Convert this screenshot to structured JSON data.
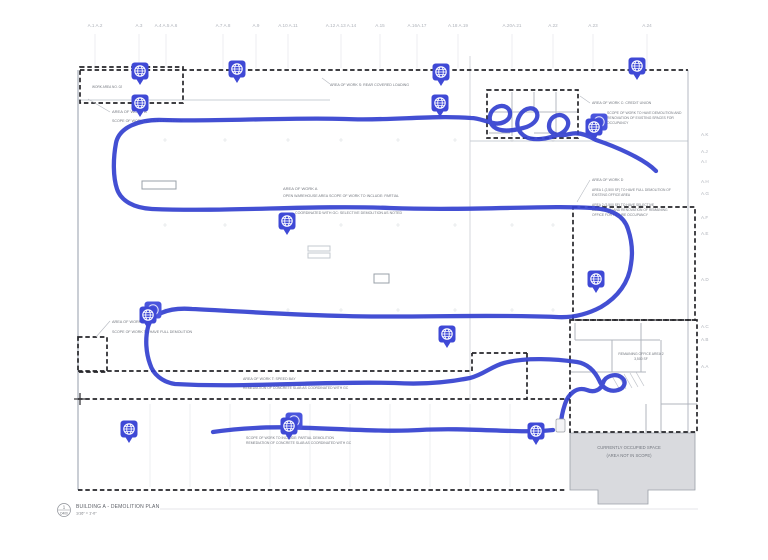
{
  "colors": {
    "path_blue": "#3340cf",
    "pin_blue": "#3f49d6",
    "pin_back": "#4a55dd",
    "dash_black": "#26262a",
    "wall_gray": "#b4bac3",
    "occupied_fill": "#d9dade",
    "annotation_text": "#73777f",
    "grid_text": "#aeb2ba"
  },
  "grid_top": {
    "y": 27,
    "labels": [
      {
        "t": "A.1 A.2",
        "x": 95
      },
      {
        "t": "A.3",
        "x": 139
      },
      {
        "t": "A.4 A.5 A.6",
        "x": 166
      },
      {
        "t": "A.7 A.8",
        "x": 223
      },
      {
        "t": "A.9",
        "x": 256
      },
      {
        "t": "A.10  A.11",
        "x": 288
      },
      {
        "t": "A.12 A.13 A.14",
        "x": 341
      },
      {
        "t": "A.15",
        "x": 380
      },
      {
        "t": "A.16A.17",
        "x": 417
      },
      {
        "t": "A.18  A.19",
        "x": 458
      },
      {
        "t": "A.20A.21",
        "x": 512
      },
      {
        "t": "A.22",
        "x": 553
      },
      {
        "t": "A.23",
        "x": 593
      },
      {
        "t": "A.24",
        "x": 647
      }
    ]
  },
  "grid_right": {
    "x": 701,
    "labels": [
      {
        "t": "A.K",
        "y": 136
      },
      {
        "t": "A.J",
        "y": 153
      },
      {
        "t": "A.I",
        "y": 163
      },
      {
        "t": "A.H",
        "y": 183
      },
      {
        "t": "A.G",
        "y": 195
      },
      {
        "t": "A.F",
        "y": 219
      },
      {
        "t": "A.E",
        "y": 235
      },
      {
        "t": "A.D",
        "y": 281
      },
      {
        "t": "A.C",
        "y": 328
      },
      {
        "t": "A.B",
        "y": 341
      },
      {
        "t": "A.A",
        "y": 368
      }
    ]
  },
  "annotations": [
    {
      "t": "WORK AREA NO. 02",
      "x": 92,
      "y": 88,
      "s": 3.2
    },
    {
      "t": "AREA OF WORK B",
      "x": 112,
      "y": 113,
      "s": 4
    },
    {
      "t": "SCOPE OF WORK TO HAVE DEMOLITION",
      "x": 112,
      "y": 122,
      "s": 3.6
    },
    {
      "t": "AREA OF WORK S: REAR COVERED LOADING",
      "x": 330,
      "y": 86,
      "s": 3.6
    },
    {
      "t": "AREA OF WORK C: CREDIT UNION",
      "x": 592,
      "y": 104,
      "s": 3.6
    },
    {
      "t": "SCOPE OF WORK TO HAVE DEMOLITION AND",
      "x": 607,
      "y": 114,
      "s": 3.4
    },
    {
      "t": "RENOVATION OF EXISTING SPACES FOR",
      "x": 607,
      "y": 119,
      "s": 3.4
    },
    {
      "t": "OCCUPANCY",
      "x": 607,
      "y": 124,
      "s": 3.4
    },
    {
      "t": "AREA OF WORK D",
      "x": 592,
      "y": 181,
      "s": 3.6
    },
    {
      "t": "AREA 1 (2,500 SF) TO HAVE FULL DEMOLITION OF",
      "x": 592,
      "y": 191,
      "s": 3.3
    },
    {
      "t": "EXISTING OFFICE AREA",
      "x": 592,
      "y": 196,
      "s": 3.3
    },
    {
      "t": "AREA 2 (3,500 SF) TO HAVE SELECTIVE",
      "x": 592,
      "y": 206,
      "s": 3.3
    },
    {
      "t": "DEMOLITION AND RENOVATION OF REMAINING",
      "x": 592,
      "y": 211,
      "s": 3.3
    },
    {
      "t": "OFFICE FOR FUTURE OCCUPANCY",
      "x": 592,
      "y": 216,
      "s": 3.3
    },
    {
      "t": "AREA OF WORK A",
      "x": 283,
      "y": 190,
      "s": 4
    },
    {
      "t": "OPEN WAREHOUSE AREA SCOPE OF WORK TO INCLUDE: PARTIAL",
      "x": 283,
      "y": 197,
      "s": 3.6
    },
    {
      "t": "COORDINATED WITH GC: SELECTIVE DEMOLITION AS NOTED",
      "x": 295,
      "y": 214,
      "s": 3.6
    },
    {
      "t": "AREA OF WORK W",
      "x": 112,
      "y": 323,
      "s": 3.8
    },
    {
      "t": "SCOPE OF WORK TO HAVE FULL DEMOLITION",
      "x": 112,
      "y": 333,
      "s": 3.6
    },
    {
      "t": "AREA OF WORK T: SPEED BAY",
      "x": 243,
      "y": 380,
      "s": 3.6
    },
    {
      "t": "REMEDIATION OF CONCRETE SLAB AS COORDINATED WITH GC",
      "x": 243,
      "y": 389,
      "s": 3.4
    },
    {
      "t": "SCOPE OF WORK TO INCLUDE: PARTIAL DEMOLITION",
      "x": 246,
      "y": 439,
      "s": 3.4
    },
    {
      "t": "REMEDIATION OF CONCRETE SLAB AS COORDINATED WITH GC",
      "x": 246,
      "y": 444,
      "s": 3.4
    },
    {
      "t": "REMAINING OFFICE AREA 2",
      "x": 641,
      "y": 355,
      "s": 3.4,
      "a": "middle"
    },
    {
      "t": "3,500 SF",
      "x": 641,
      "y": 360,
      "s": 3.4,
      "a": "middle"
    },
    {
      "t": "CURRENTLY OCCUPIED SPACE",
      "x": 629,
      "y": 449,
      "s": 4.2,
      "a": "middle"
    },
    {
      "t": "(AREA NOT IN SCOPE)",
      "x": 629,
      "y": 457,
      "s": 4.2,
      "a": "middle"
    }
  ],
  "pins": [
    {
      "x": 140,
      "y": 71
    },
    {
      "x": 237,
      "y": 69
    },
    {
      "x": 441,
      "y": 72
    },
    {
      "x": 637,
      "y": 66
    },
    {
      "x": 140,
      "y": 103
    },
    {
      "x": 440,
      "y": 103
    },
    {
      "x": 594,
      "y": 127,
      "double": true
    },
    {
      "x": 287,
      "y": 221
    },
    {
      "x": 596,
      "y": 279
    },
    {
      "x": 148,
      "y": 315,
      "double": true
    },
    {
      "x": 447,
      "y": 334
    },
    {
      "x": 129,
      "y": 429
    },
    {
      "x": 289,
      "y": 426,
      "double": true
    },
    {
      "x": 536,
      "y": 431
    }
  ],
  "walk_path": {
    "width": 4.3,
    "segments": [
      "M656,171 C643,158 614,146 596,140 C586,134 578,132 570,134 C558,137 549,134 549,126 C549,117 559,112 565,117 C571,122 568,130 560,134 C548,139 534,141 526,137 C517,132 515,123 520,115 C525,107 535,106 537,113 C539,120 532,126 523,128 C512,131 500,132 494,127 C487,121 489,111 497,107 C504,104 511,108 510,115 C509,121 501,125 493,123 C484,121 478,118 471,118 C430,115 390,121 345,119 C290,117 210,122 163,120 C138,119 119,128 116,143 C113,159 113,177 117,189 C121,201 134,208 152,209 C230,212 310,205 390,208 C470,211 550,205 592,208 C612,209 624,216 628,229 C632,241 633,252 631,264 C629,282 618,297 601,307 C586,315 570,318 556,317 C480,314 410,318 345,316 C292,315 235,311 192,309 C167,307 151,315 148,327 C145,339 146,353 150,364 C153,374 162,382 175,384 C245,388 320,381 395,383 C428,385 455,381 470,378 C483,375 492,366 504,363 C526,357 556,359 577,362 C589,364 596,373 600,382 C604,390 612,392 618,390 C625,388 627,381 621,377 C615,373 605,376 603,383 C601,390 594,393 587,390 C576,386 568,395 565,404 C562,413 561,419 561,425",
      "M553,430 C520,434 470,427 420,430 C370,433 300,425 255,428 C235,429 220,431 213,432"
    ],
    "end_cap": {
      "x": 556,
      "y": 419,
      "w": 9,
      "h": 13
    }
  },
  "title_block": {
    "detail_number": "1",
    "sheet_ref": "D400",
    "title": "BUILDING A - DEMOLITION PLAN",
    "scale": "1/16\" = 1'-0\""
  }
}
